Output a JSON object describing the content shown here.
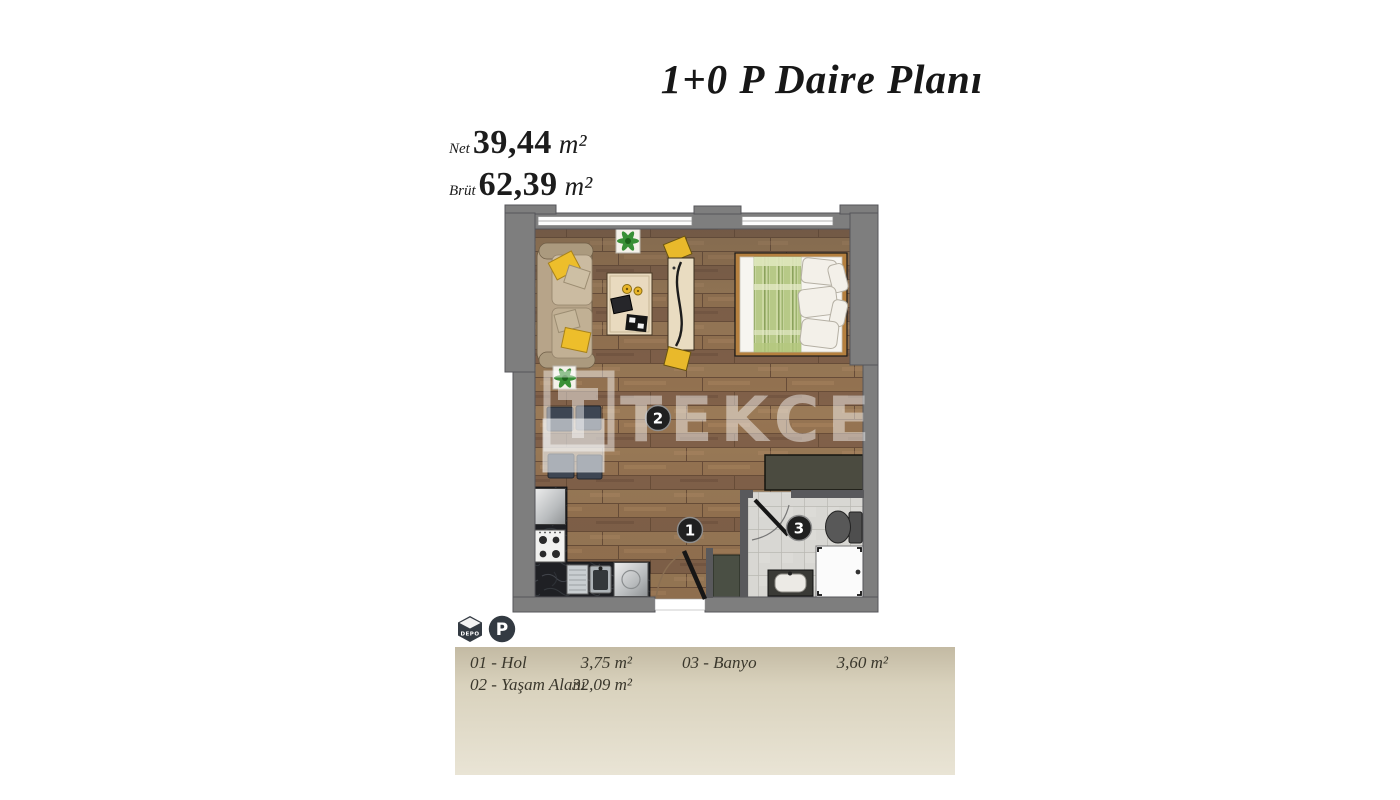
{
  "header": {
    "title": "1+0 P Daire Planı"
  },
  "areas": {
    "net": {
      "label": "Net",
      "value": "39,44",
      "unit": "m²"
    },
    "gross": {
      "label": "Brüt",
      "value": "62,39",
      "unit": "m²"
    }
  },
  "badges": {
    "storage_label": "DEPO",
    "parking_label": "P"
  },
  "plan": {
    "watermark": "TEKCE",
    "markers": [
      "1",
      "2",
      "3"
    ]
  },
  "legend": {
    "items": [
      {
        "label": "01 - Hol",
        "area": "3,75 m²"
      },
      {
        "label": "02 - Yaşam Alanı",
        "area": "32,09 m²"
      },
      {
        "label": "03 - Banyo",
        "area": "3,60 m²"
      }
    ]
  },
  "colors": {
    "wall": "#7e7e7e",
    "floor_wood": "#8d6c4e",
    "accent_yellow": "#edbe2b",
    "bed_blanket_green": "#c9d69e",
    "legend_bg": "#d8d1bd",
    "marker_bg": "#202020"
  }
}
